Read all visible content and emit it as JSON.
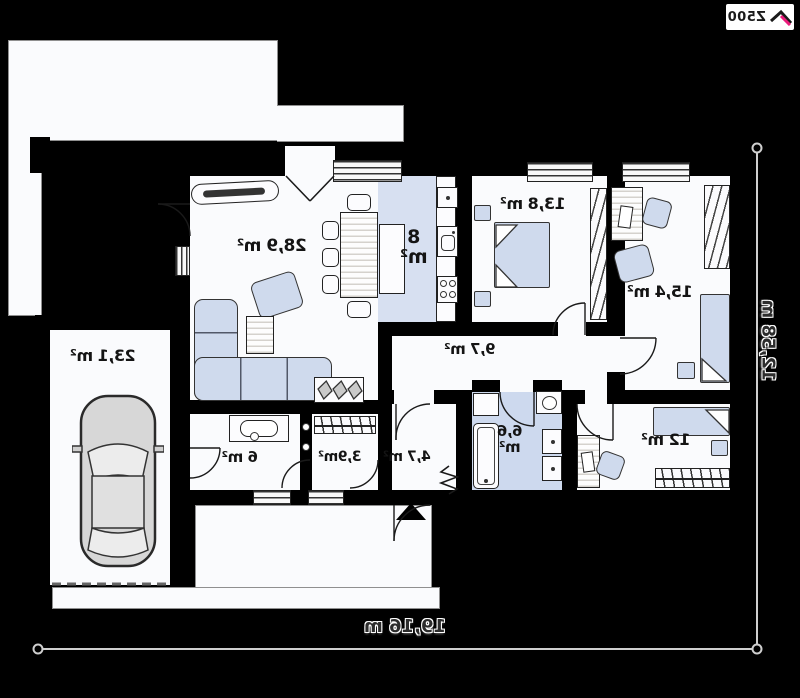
{
  "logo": {
    "brand": "Z500"
  },
  "plan": {
    "rooms": {
      "living_room": {
        "area_label": "28,9 m²"
      },
      "kitchen": {
        "area_value": "8",
        "area_unit": "m²"
      },
      "bedroom_top": {
        "area_label": "13,8 m²"
      },
      "bedroom_right": {
        "area_label": "15,4 m²"
      },
      "bedroom_bottom": {
        "area_label": "12 m²"
      },
      "hallway": {
        "area_label": "9,7 m²"
      },
      "bathroom": {
        "area_value": "6,6",
        "area_unit": "m²"
      },
      "vestibule": {
        "area_label": "4,7 m²"
      },
      "wardrobe": {
        "area_label": "3,9m²"
      },
      "entry_hall": {
        "area_label": "6 m²"
      },
      "garage": {
        "area_label": "23,1 m²"
      }
    },
    "dimensions": {
      "width_label": "19,16 m",
      "height_label": "12,58 m"
    }
  },
  "colors": {
    "background": "#000000",
    "plan_white": "#fafbfd",
    "floor_accent_kitchen": "#d7e0f1",
    "floor_accent_bath": "#cdd9ee",
    "furniture_fill": "#cfdaed",
    "logo_pink": "#ec1c7c",
    "dimension_line": "#cfcfcf"
  }
}
